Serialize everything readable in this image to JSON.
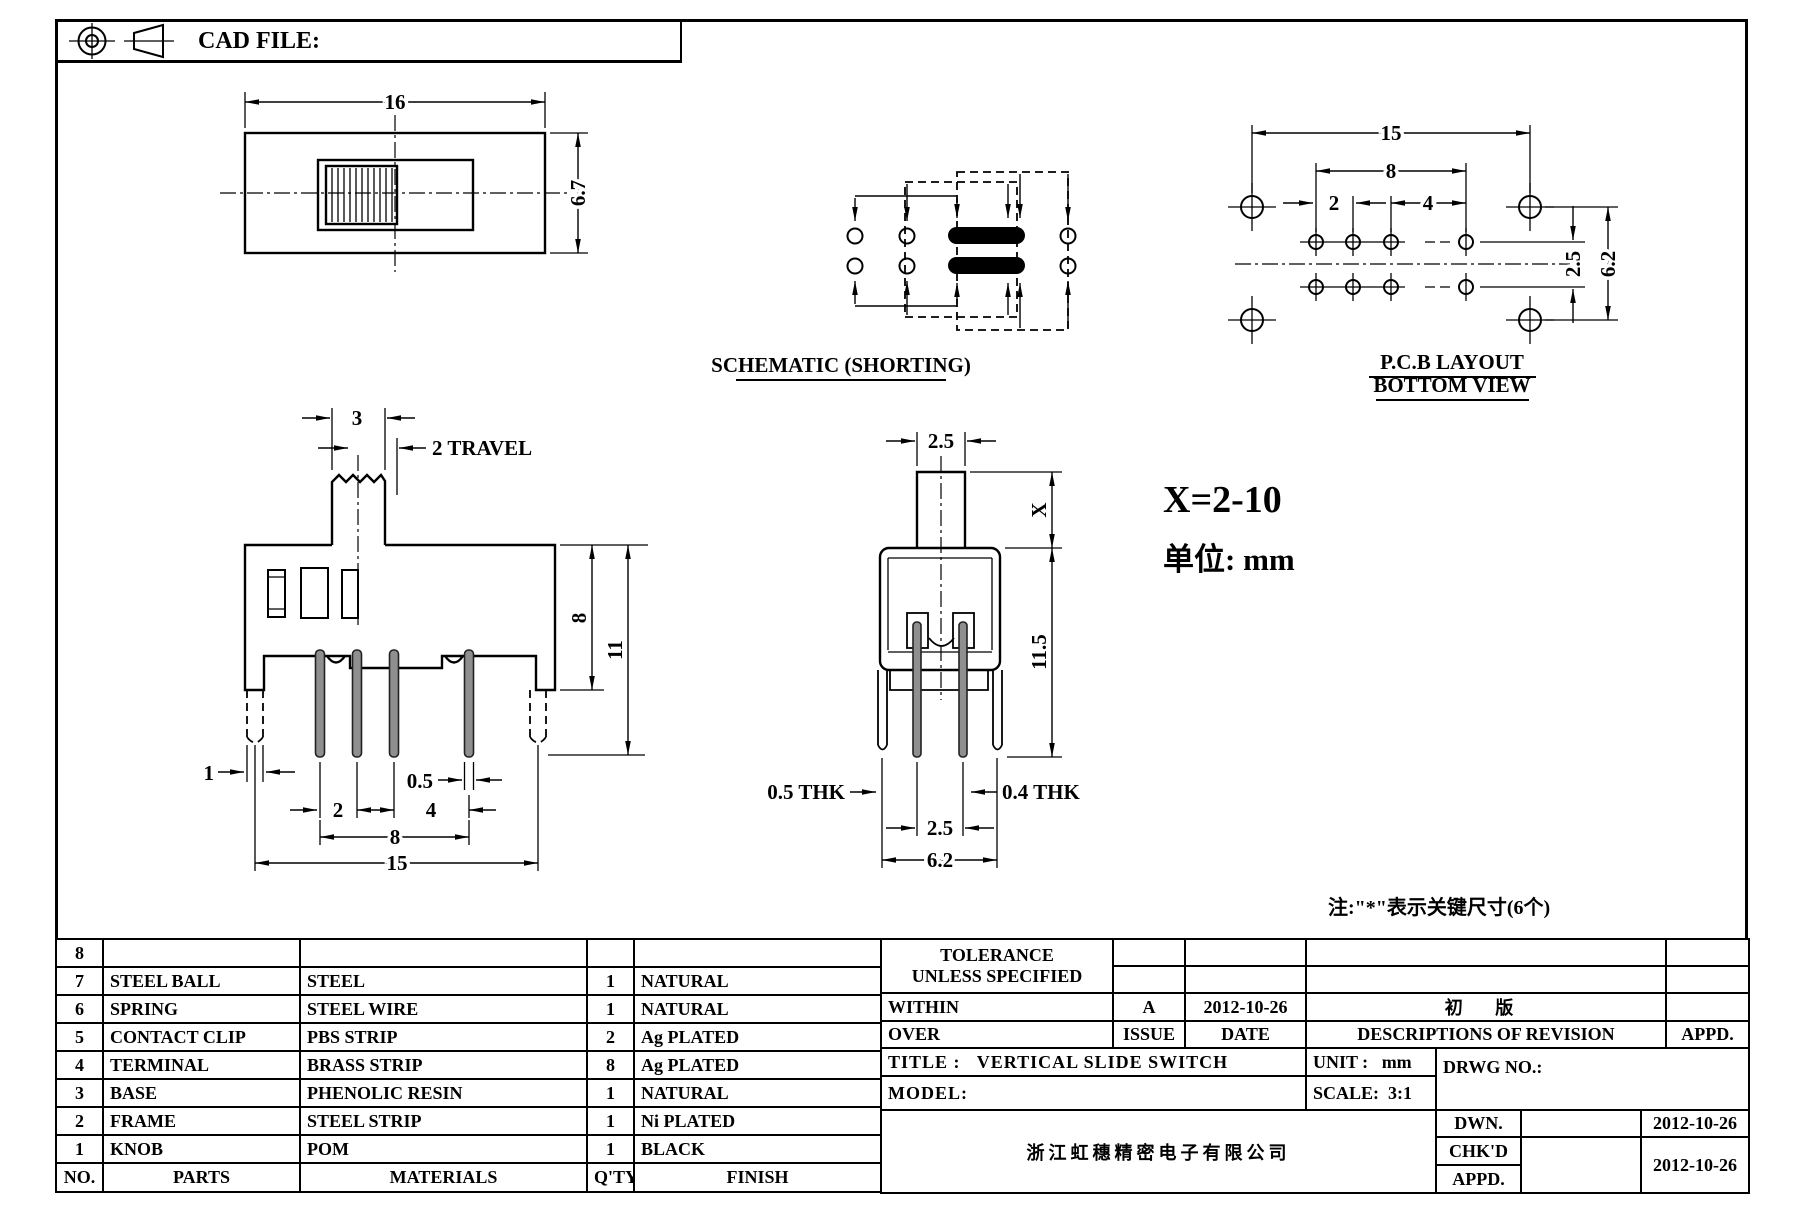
{
  "header": {
    "cad_file_label": "CAD FILE:"
  },
  "drawing": {
    "top_view": {
      "width": "16",
      "height": "6.7"
    },
    "schematic": {
      "caption": "SCHEMATIC (SHORTING)"
    },
    "pcb": {
      "overall": "15",
      "span": "8",
      "pitch_a": "2",
      "pitch_b": "4",
      "row_pitch": "2.5",
      "height": "6.2",
      "caption1": "P.C.B LAYOUT",
      "caption2": "BOTTOM VIEW"
    },
    "front": {
      "knob_width": "3",
      "travel": "2 TRAVEL",
      "body_height": "8",
      "total_height": "11",
      "leg_width": "1",
      "pin_thk": "0.5",
      "pitch_a": "2",
      "pitch_b": "4",
      "span": "8",
      "overall": "15"
    },
    "side": {
      "stem_width": "2.5",
      "stem_height": "X",
      "height": "11.5",
      "thk_left": "0.5 THK",
      "thk_right": "0.4 THK",
      "pin_pitch": "2.5",
      "overall": "6.2"
    },
    "notes": {
      "x_range": "X=2-10",
      "unit": "单位: mm",
      "key": "注:\"*\"表示关键尺寸(6个)"
    }
  },
  "parts_table": {
    "headers": {
      "no": "NO.",
      "parts": "PARTS",
      "materials": "MATERIALS",
      "qty": "Q'TY",
      "finish": "FINISH"
    },
    "rows": [
      {
        "no": "8",
        "parts": "",
        "materials": "",
        "qty": "",
        "finish": ""
      },
      {
        "no": "7",
        "parts": "STEEL BALL",
        "materials": "STEEL",
        "qty": "1",
        "finish": "NATURAL"
      },
      {
        "no": "6",
        "parts": "SPRING",
        "materials": "STEEL WIRE",
        "qty": "1",
        "finish": "NATURAL"
      },
      {
        "no": "5",
        "parts": "CONTACT CLIP",
        "materials": "PBS STRIP",
        "qty": "2",
        "finish": "Ag PLATED"
      },
      {
        "no": "4",
        "parts": "TERMINAL",
        "materials": "BRASS STRIP",
        "qty": "8",
        "finish": "Ag PLATED"
      },
      {
        "no": "3",
        "parts": "BASE",
        "materials": "PHENOLIC RESIN",
        "qty": "1",
        "finish": "NATURAL"
      },
      {
        "no": "2",
        "parts": "FRAME",
        "materials": "STEEL STRIP",
        "qty": "1",
        "finish": "Ni PLATED"
      },
      {
        "no": "1",
        "parts": "KNOB",
        "materials": "POM",
        "qty": "1",
        "finish": "BLACK"
      }
    ]
  },
  "tolerance_block": {
    "line1": "TOLERANCE",
    "line2": "UNLESS  SPECIFIED",
    "within_label": "WITHIN",
    "over_label": "OVER",
    "issue_value": "A",
    "date_value": "2012-10-26",
    "revision_value": "初 版",
    "issue_label": "ISSUE",
    "date_label": "DATE",
    "revision_label": "DESCRIPTIONS OF REVISION",
    "appd_label": "APPD."
  },
  "title_block": {
    "title_label": "TITLE :",
    "title_value": "VERTICAL SLIDE SWITCH",
    "unit_label": "UNIT :",
    "unit_value": "mm",
    "model_label": "MODEL:",
    "scale_label": "SCALE:",
    "scale_value": "3:1",
    "drwg_label": "DRWG NO.:",
    "company": "浙江虹穗精密电子有限公司",
    "dwn_label": "DWN.",
    "dwn_date": "2012-10-26",
    "chkd_label": "CHK'D",
    "appd_label": "APPD.",
    "chkd_appd_date": "2012-10-26"
  }
}
